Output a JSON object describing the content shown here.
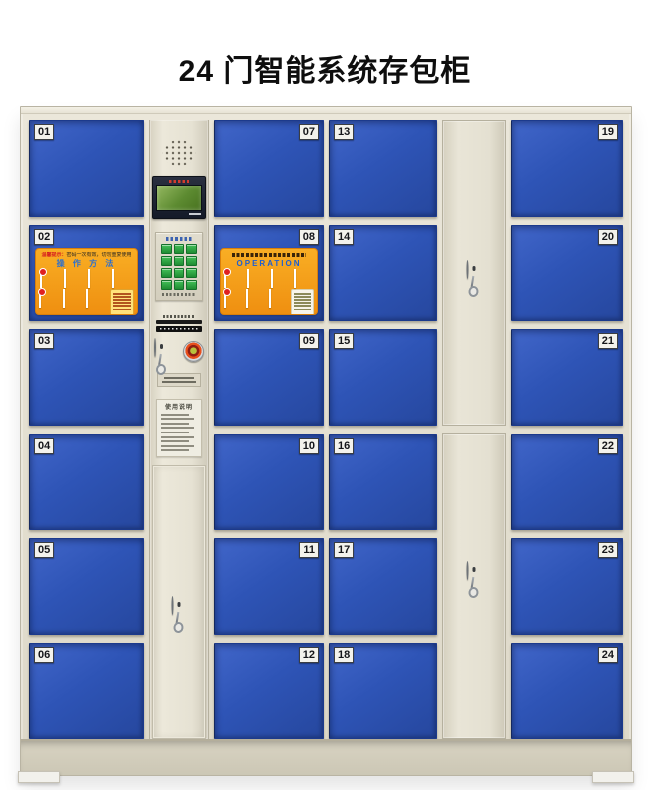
{
  "page_title": "24 门智能系统存包柜",
  "doors": [
    {
      "no": "01",
      "plate_side": "left"
    },
    {
      "no": "02",
      "plate_side": "left"
    },
    {
      "no": "03",
      "plate_side": "left"
    },
    {
      "no": "04",
      "plate_side": "left"
    },
    {
      "no": "05",
      "plate_side": "left"
    },
    {
      "no": "06",
      "plate_side": "left"
    },
    {
      "no": "07",
      "plate_side": "right"
    },
    {
      "no": "08",
      "plate_side": "right"
    },
    {
      "no": "09",
      "plate_side": "right"
    },
    {
      "no": "10",
      "plate_side": "right"
    },
    {
      "no": "11",
      "plate_side": "right"
    },
    {
      "no": "12",
      "plate_side": "right"
    },
    {
      "no": "13",
      "plate_side": "left"
    },
    {
      "no": "14",
      "plate_side": "left"
    },
    {
      "no": "15",
      "plate_side": "left"
    },
    {
      "no": "16",
      "plate_side": "left"
    },
    {
      "no": "17",
      "plate_side": "left"
    },
    {
      "no": "18",
      "plate_side": "left"
    },
    {
      "no": "19",
      "plate_side": "right"
    },
    {
      "no": "20",
      "plate_side": "right"
    },
    {
      "no": "21",
      "plate_side": "right"
    },
    {
      "no": "22",
      "plate_side": "right"
    },
    {
      "no": "23",
      "plate_side": "right"
    },
    {
      "no": "24",
      "plate_side": "right"
    }
  ],
  "stickers": {
    "door02": {
      "notice_prefix": "温馨提示：",
      "notice_body": "密码一次有效，切勿重复使用",
      "title": "操 作 方 法"
    },
    "door08": {
      "title": "OPERATION"
    }
  },
  "control_panel": {
    "instructions_title": "使用说明"
  },
  "colors": {
    "door_blue": "#2e54b6",
    "frame_beige": "#e3dfd0",
    "sticker_orange": "#f6a21c",
    "keypad_green": "#2fa13f",
    "screen_green": "#5d8b31",
    "emergency_red": "#e84f1d"
  }
}
